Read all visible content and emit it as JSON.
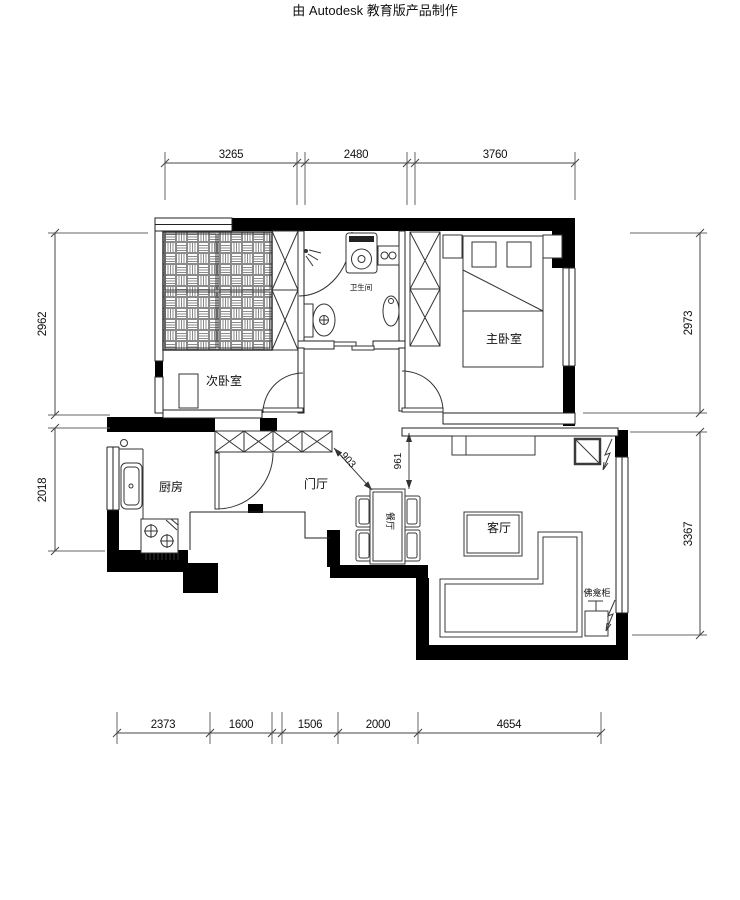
{
  "watermark": "由 Autodesk 教育版产品制作",
  "rooms": {
    "secondary_bedroom": "次卧室",
    "master_bedroom": "主卧室",
    "bathroom": "卫生间",
    "kitchen": "厨房",
    "entry_hall": "门厅",
    "dining": "餐厅",
    "living": "客厅",
    "shrine_cabinet": "佛龛柜"
  },
  "dimensions": {
    "top": [
      "3265",
      "2480",
      "3760"
    ],
    "left": [
      "2962",
      "2018"
    ],
    "right": [
      "2973",
      "3367"
    ],
    "bottom": [
      "2373",
      "1600",
      "1506",
      "2000",
      "4654"
    ],
    "interior": [
      "903",
      "961"
    ]
  },
  "colors": {
    "wall": "#000000",
    "line": "#2b2b2b",
    "furniture_line": "#3a3a3a",
    "watermark": "#ece9e9"
  }
}
